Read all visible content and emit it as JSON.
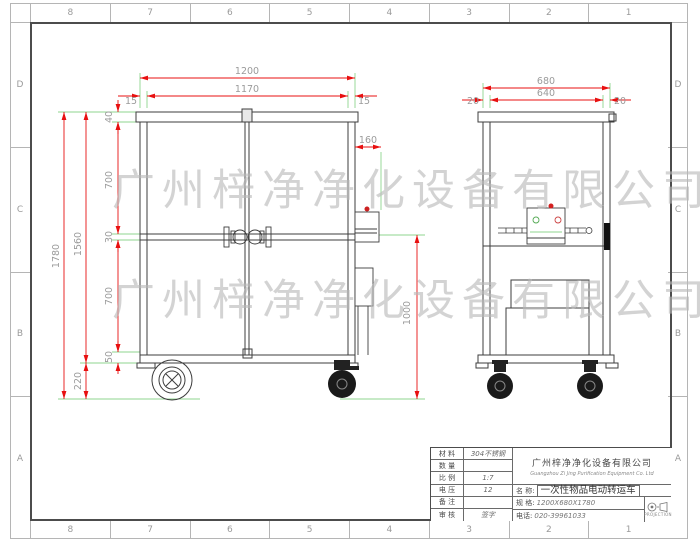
{
  "frame": {
    "cols": [
      "8",
      "7",
      "6",
      "5",
      "4",
      "3",
      "2",
      "1"
    ],
    "rows": [
      "D",
      "C",
      "B",
      "A"
    ]
  },
  "watermark": {
    "text": "广州梓净净化设备有限公司"
  },
  "dims": {
    "front_total_w": "1200",
    "front_inner_w": "1170",
    "front_edge_l": "15",
    "front_edge_r": "15",
    "side_total_w": "680",
    "side_inner_w": "640",
    "side_edge_l": "20",
    "side_edge_r": "20",
    "total_h": "1780",
    "body_h": "1560",
    "cap_h": "40",
    "upper_panel_h": "700",
    "rail_h": "30",
    "lower_panel_h": "700",
    "base_h": "50",
    "wheel_h": "220",
    "handle_depth": "160",
    "handle_floor_h": "1000"
  },
  "title_block": {
    "left_rows": [
      {
        "label": "材 料",
        "value": "304不锈钢"
      },
      {
        "label": "数 量",
        "value": ""
      },
      {
        "label": "比 例",
        "value": "1:7"
      },
      {
        "label": "电 压",
        "value": "12"
      },
      {
        "label": "备 注",
        "value": ""
      },
      {
        "label": "审 核",
        "value": "签字"
      }
    ],
    "company_cn": "广州梓净净化设备有限公司",
    "company_en": "Guangzhou Zi Jing Purification Equipment Co. Ltd",
    "name_label": "名  称:",
    "name_value": "一次性物品电动转运车",
    "spec_label": "规  格:",
    "spec_value": "1200X680X1780",
    "phone_label": "电话:",
    "phone_value": "020-39961033",
    "projection": "PROJECTION"
  }
}
